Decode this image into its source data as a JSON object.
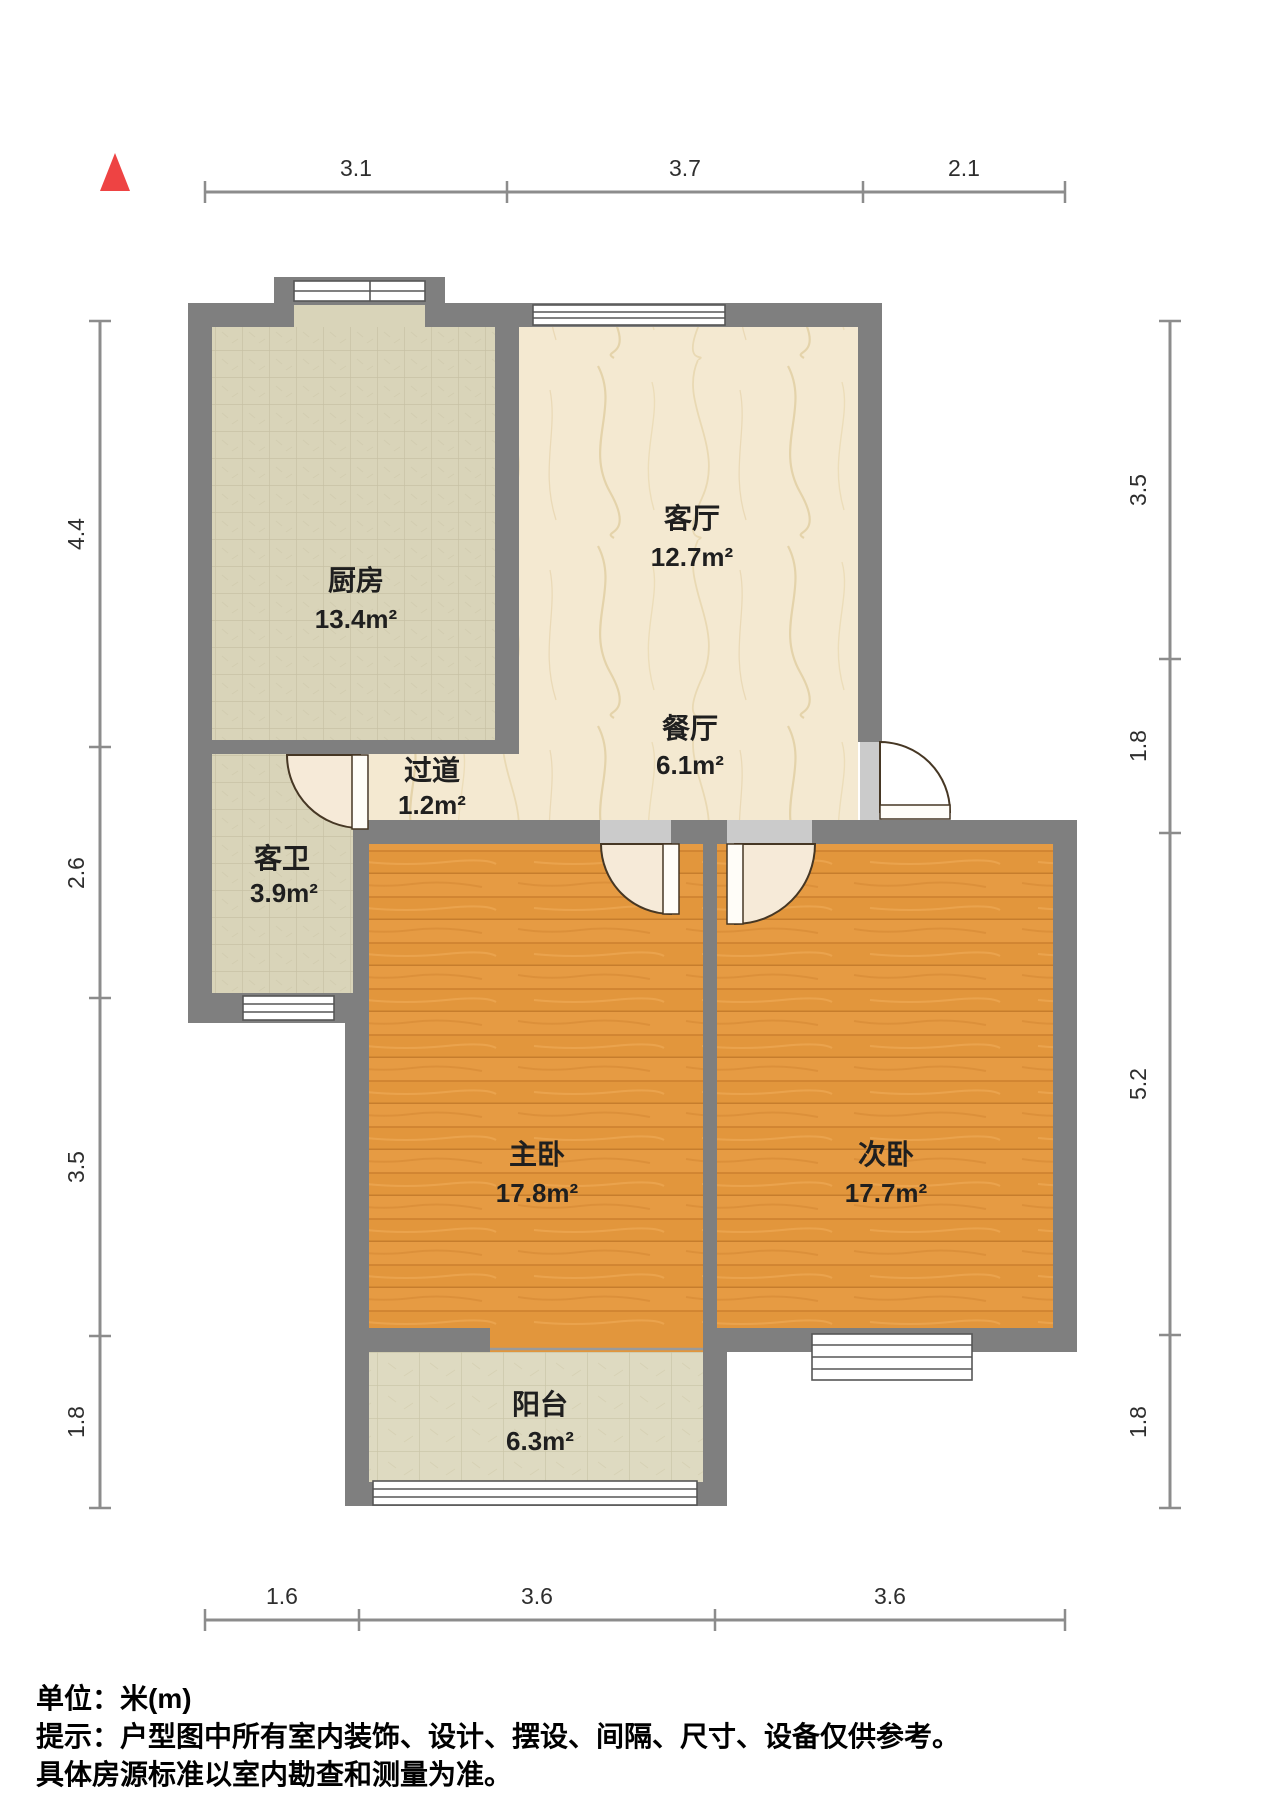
{
  "title": "户型图 (apartment floor plan)",
  "compass": {
    "label": "north-indicator",
    "color": "#ee4343"
  },
  "rooms": {
    "kitchen": {
      "name": "厨房",
      "area": "13.4m²"
    },
    "living": {
      "name": "客厅",
      "area": "12.7m²"
    },
    "dining": {
      "name": "餐厅",
      "area": "6.1m²"
    },
    "hallway": {
      "name": "过道",
      "area": "1.2m²"
    },
    "bathroom": {
      "name": "客卫",
      "area": "3.9m²"
    },
    "master_bedroom": {
      "name": "主卧",
      "area": "17.8m²"
    },
    "second_bedroom": {
      "name": "次卧",
      "area": "17.7m²"
    },
    "balcony": {
      "name": "阳台",
      "area": "6.3m²"
    }
  },
  "dimensions": {
    "top": [
      "3.1",
      "3.7",
      "2.1"
    ],
    "left": [
      "4.4",
      "2.6",
      "3.5",
      "1.8"
    ],
    "right": [
      "3.5",
      "1.8",
      "5.2",
      "1.8"
    ],
    "bottom": [
      "1.6",
      "3.6",
      "3.6"
    ]
  },
  "footer": {
    "unit_line": "单位：米(m)",
    "note_line1": "提示：户型图中所有室内装饰、设计、摆设、间隔、尺寸、设备仅供参考。",
    "note_line2": "具体房源标准以室内勘查和测量为准。"
  },
  "palette": {
    "wall_gray": "#7f7f7f",
    "jamb_gray": "#cbcbcb",
    "kitchen_tile": "#d9d4b9",
    "balcony_tile": "#dedac1",
    "marble_cream": "#f4e9d1",
    "wood_orange": "#e2963c",
    "door_fan": "#f6ead8",
    "window_white": "#ffffff",
    "dim_line_gray": "#8c8c8c",
    "compass_red": "#ee4343"
  }
}
